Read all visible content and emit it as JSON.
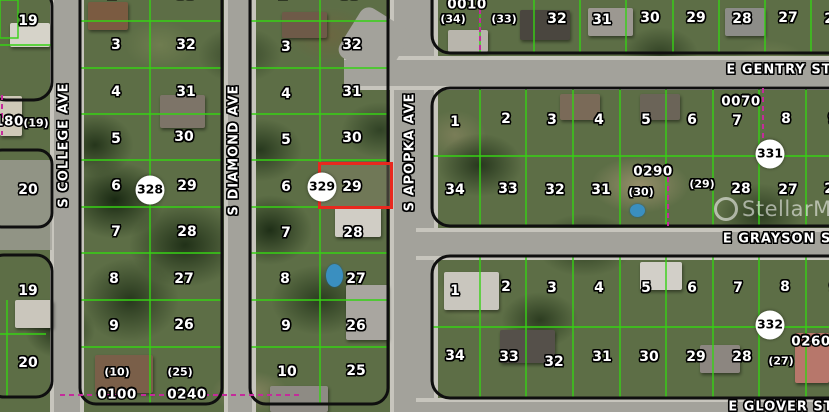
{
  "map": {
    "watermark": "StellarMLS",
    "highlight": {
      "parcel": "29",
      "color": "#e8281e",
      "x": 318,
      "y": 162,
      "w": 75,
      "h": 47
    },
    "streets": {
      "vertical": [
        "S COLLEGE AVE",
        "S DIAMOND AVE",
        "S APOPKA AVE"
      ],
      "horizontal": [
        "E GENTRY ST",
        "E GRAYSON ST",
        "E GLOVER ST"
      ]
    },
    "circled_markers": [
      "328",
      "329",
      "331",
      "332"
    ],
    "block_numbers": [
      "0010",
      "0070",
      "0290",
      "0100",
      "0240",
      "0260",
      "180"
    ],
    "labels": [
      {
        "t": "19",
        "x": 28,
        "y": 21,
        "k": "p"
      },
      {
        "t": "20",
        "x": 28,
        "y": 190,
        "k": "p"
      },
      {
        "t": "19",
        "x": 28,
        "y": 291,
        "k": "p"
      },
      {
        "t": "20",
        "x": 28,
        "y": 363,
        "k": "p"
      },
      {
        "t": "180",
        "x": 9,
        "y": 122,
        "k": "b"
      },
      {
        "t": "(19)",
        "x": 36,
        "y": 123,
        "k": "pr"
      },
      {
        "t": "2",
        "x": 112,
        "y": -5,
        "k": "p"
      },
      {
        "t": "33",
        "x": 186,
        "y": -5,
        "k": "p"
      },
      {
        "t": "3",
        "x": 116,
        "y": 45,
        "k": "p"
      },
      {
        "t": "32",
        "x": 186,
        "y": 45,
        "k": "p"
      },
      {
        "t": "4",
        "x": 116,
        "y": 92,
        "k": "p"
      },
      {
        "t": "31",
        "x": 186,
        "y": 92,
        "k": "p"
      },
      {
        "t": "5",
        "x": 116,
        "y": 139,
        "k": "p"
      },
      {
        "t": "30",
        "x": 184,
        "y": 137,
        "k": "p"
      },
      {
        "t": "6",
        "x": 116,
        "y": 186,
        "k": "p"
      },
      {
        "t": "29",
        "x": 187,
        "y": 186,
        "k": "p"
      },
      {
        "t": "7",
        "x": 116,
        "y": 232,
        "k": "p"
      },
      {
        "t": "28",
        "x": 187,
        "y": 232,
        "k": "p"
      },
      {
        "t": "8",
        "x": 114,
        "y": 279,
        "k": "p"
      },
      {
        "t": "27",
        "x": 184,
        "y": 279,
        "k": "p"
      },
      {
        "t": "9",
        "x": 114,
        "y": 326,
        "k": "p"
      },
      {
        "t": "26",
        "x": 184,
        "y": 325,
        "k": "p"
      },
      {
        "t": "(10)",
        "x": 117,
        "y": 372,
        "k": "pr"
      },
      {
        "t": "0100",
        "x": 117,
        "y": 395,
        "k": "b"
      },
      {
        "t": "(25)",
        "x": 180,
        "y": 372,
        "k": "pr"
      },
      {
        "t": "0240",
        "x": 187,
        "y": 395,
        "k": "b"
      },
      {
        "t": "2",
        "x": 283,
        "y": -5,
        "k": "p"
      },
      {
        "t": "33",
        "x": 350,
        "y": -5,
        "k": "p"
      },
      {
        "t": "3",
        "x": 286,
        "y": 47,
        "k": "p"
      },
      {
        "t": "32",
        "x": 352,
        "y": 45,
        "k": "p"
      },
      {
        "t": "4",
        "x": 286,
        "y": 94,
        "k": "p"
      },
      {
        "t": "31",
        "x": 352,
        "y": 92,
        "k": "p"
      },
      {
        "t": "5",
        "x": 286,
        "y": 140,
        "k": "p"
      },
      {
        "t": "30",
        "x": 352,
        "y": 138,
        "k": "p"
      },
      {
        "t": "6",
        "x": 286,
        "y": 187,
        "k": "p"
      },
      {
        "t": "29",
        "x": 352,
        "y": 187,
        "k": "p"
      },
      {
        "t": "7",
        "x": 286,
        "y": 233,
        "k": "p"
      },
      {
        "t": "28",
        "x": 353,
        "y": 233,
        "k": "p"
      },
      {
        "t": "8",
        "x": 285,
        "y": 279,
        "k": "p"
      },
      {
        "t": "27",
        "x": 356,
        "y": 279,
        "k": "p"
      },
      {
        "t": "9",
        "x": 286,
        "y": 326,
        "k": "p"
      },
      {
        "t": "26",
        "x": 356,
        "y": 326,
        "k": "p"
      },
      {
        "t": "10",
        "x": 287,
        "y": 372,
        "k": "p"
      },
      {
        "t": "25",
        "x": 356,
        "y": 371,
        "k": "p"
      },
      {
        "t": "0010",
        "x": 467,
        "y": 5,
        "k": "b"
      },
      {
        "t": "(34)",
        "x": 453,
        "y": 19,
        "k": "pr"
      },
      {
        "t": "(33)",
        "x": 504,
        "y": 19,
        "k": "pr"
      },
      {
        "t": "32",
        "x": 557,
        "y": 19,
        "k": "p"
      },
      {
        "t": "31",
        "x": 602,
        "y": 20,
        "k": "p"
      },
      {
        "t": "30",
        "x": 650,
        "y": 18,
        "k": "p"
      },
      {
        "t": "29",
        "x": 696,
        "y": 18,
        "k": "p"
      },
      {
        "t": "28",
        "x": 742,
        "y": 19,
        "k": "p"
      },
      {
        "t": "27",
        "x": 788,
        "y": 18,
        "k": "p"
      },
      {
        "t": "26",
        "x": 834,
        "y": 19,
        "k": "p"
      },
      {
        "t": "1",
        "x": 455,
        "y": 122,
        "k": "p"
      },
      {
        "t": "2",
        "x": 506,
        "y": 119,
        "k": "p"
      },
      {
        "t": "3",
        "x": 552,
        "y": 120,
        "k": "p"
      },
      {
        "t": "4",
        "x": 599,
        "y": 120,
        "k": "p"
      },
      {
        "t": "5",
        "x": 646,
        "y": 120,
        "k": "p"
      },
      {
        "t": "6",
        "x": 692,
        "y": 120,
        "k": "p"
      },
      {
        "t": "0070",
        "x": 741,
        "y": 102,
        "k": "b"
      },
      {
        "t": "7",
        "x": 737,
        "y": 121,
        "k": "p"
      },
      {
        "t": "8",
        "x": 786,
        "y": 119,
        "k": "p"
      },
      {
        "t": "9",
        "x": 833,
        "y": 119,
        "k": "p"
      },
      {
        "t": "34",
        "x": 455,
        "y": 190,
        "k": "p"
      },
      {
        "t": "33",
        "x": 508,
        "y": 189,
        "k": "p"
      },
      {
        "t": "32",
        "x": 555,
        "y": 190,
        "k": "p"
      },
      {
        "t": "31",
        "x": 601,
        "y": 190,
        "k": "p"
      },
      {
        "t": "0290",
        "x": 653,
        "y": 172,
        "k": "b"
      },
      {
        "t": "(30)",
        "x": 641,
        "y": 192,
        "k": "pr"
      },
      {
        "t": "(29)",
        "x": 702,
        "y": 184,
        "k": "pr"
      },
      {
        "t": "28",
        "x": 741,
        "y": 189,
        "k": "p"
      },
      {
        "t": "27",
        "x": 788,
        "y": 190,
        "k": "p"
      },
      {
        "t": "26",
        "x": 834,
        "y": 189,
        "k": "p"
      },
      {
        "t": "1",
        "x": 455,
        "y": 291,
        "k": "p"
      },
      {
        "t": "2",
        "x": 506,
        "y": 287,
        "k": "p"
      },
      {
        "t": "3",
        "x": 552,
        "y": 288,
        "k": "p"
      },
      {
        "t": "4",
        "x": 599,
        "y": 288,
        "k": "p"
      },
      {
        "t": "5",
        "x": 646,
        "y": 288,
        "k": "p"
      },
      {
        "t": "6",
        "x": 692,
        "y": 288,
        "k": "p"
      },
      {
        "t": "7",
        "x": 738,
        "y": 288,
        "k": "p"
      },
      {
        "t": "8",
        "x": 785,
        "y": 287,
        "k": "p"
      },
      {
        "t": "9",
        "x": 834,
        "y": 288,
        "k": "p"
      },
      {
        "t": "34",
        "x": 455,
        "y": 356,
        "k": "p"
      },
      {
        "t": "33",
        "x": 509,
        "y": 357,
        "k": "p"
      },
      {
        "t": "32",
        "x": 554,
        "y": 362,
        "k": "p"
      },
      {
        "t": "31",
        "x": 602,
        "y": 357,
        "k": "p"
      },
      {
        "t": "30",
        "x": 649,
        "y": 357,
        "k": "p"
      },
      {
        "t": "29",
        "x": 696,
        "y": 357,
        "k": "p"
      },
      {
        "t": "28",
        "x": 742,
        "y": 357,
        "k": "p"
      },
      {
        "t": "(27)",
        "x": 781,
        "y": 361,
        "k": "pr"
      },
      {
        "t": "0260",
        "x": 811,
        "y": 342,
        "k": "b"
      },
      {
        "t": "328",
        "x": 150,
        "y": 190,
        "k": "c"
      },
      {
        "t": "329",
        "x": 322,
        "y": 187,
        "k": "c"
      },
      {
        "t": "331",
        "x": 770,
        "y": 154,
        "k": "c"
      },
      {
        "t": "332",
        "x": 770,
        "y": 325,
        "k": "c"
      },
      {
        "t": "S COLLEGE AVE",
        "x": 64,
        "y": 145,
        "k": "sv"
      },
      {
        "t": "S DIAMOND AVE",
        "x": 234,
        "y": 150,
        "k": "sv"
      },
      {
        "t": "S APOPKA AVE",
        "x": 410,
        "y": 152,
        "k": "sv"
      },
      {
        "t": "E GENTRY ST",
        "x": 779,
        "y": 70,
        "k": "sh"
      },
      {
        "t": "E GRAYSON ST",
        "x": 782,
        "y": 239,
        "k": "sh"
      },
      {
        "t": "E GLOVER ST",
        "x": 781,
        "y": 407,
        "k": "sh"
      }
    ]
  }
}
